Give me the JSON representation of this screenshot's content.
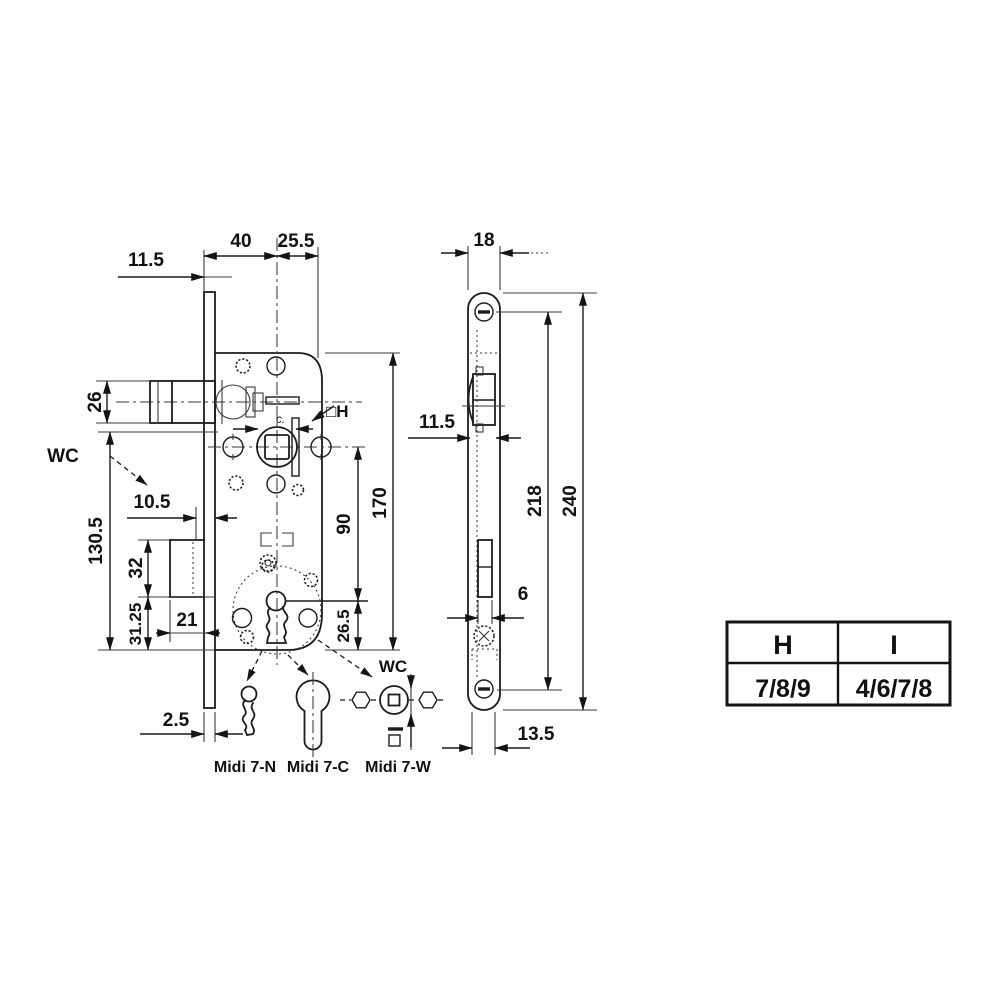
{
  "front_view": {
    "dim_backset": "40",
    "dim_backset_right": "25.5",
    "dim_top_left": "11.5",
    "dim_latch_height": "26",
    "wc_label_left": "WC",
    "dim_deadbolt_inset": "10.5",
    "dim_lower_height": "130.5",
    "dim_deadbolt_height": "32",
    "dim_bottom_section": "31.25",
    "dim_deadbolt_width": "21",
    "dim_plate_thickness": "2.5",
    "dim_spindle_to_key": "90",
    "dim_body_height": "170",
    "dim_key_to_bottom": "26.5",
    "spindle_size_label": "□H",
    "detail_label": "c.",
    "wc_label_bottom": "WC"
  },
  "side_view": {
    "dim_plate_width": "18",
    "dim_latch_width": "11.5",
    "dim_screw_spacing": "218",
    "dim_plate_length": "240",
    "dim_bolt_thickness": "6",
    "dim_bottom_offset": "13.5"
  },
  "variants": {
    "n_label": "Midi 7-N",
    "c_label": "Midi 7-C",
    "w_label": "Midi 7-W",
    "w_wc_label": "WC"
  },
  "spec_table": {
    "headers": [
      "H",
      "I"
    ],
    "values": [
      "7/8/9",
      "4/6/7/8"
    ]
  }
}
